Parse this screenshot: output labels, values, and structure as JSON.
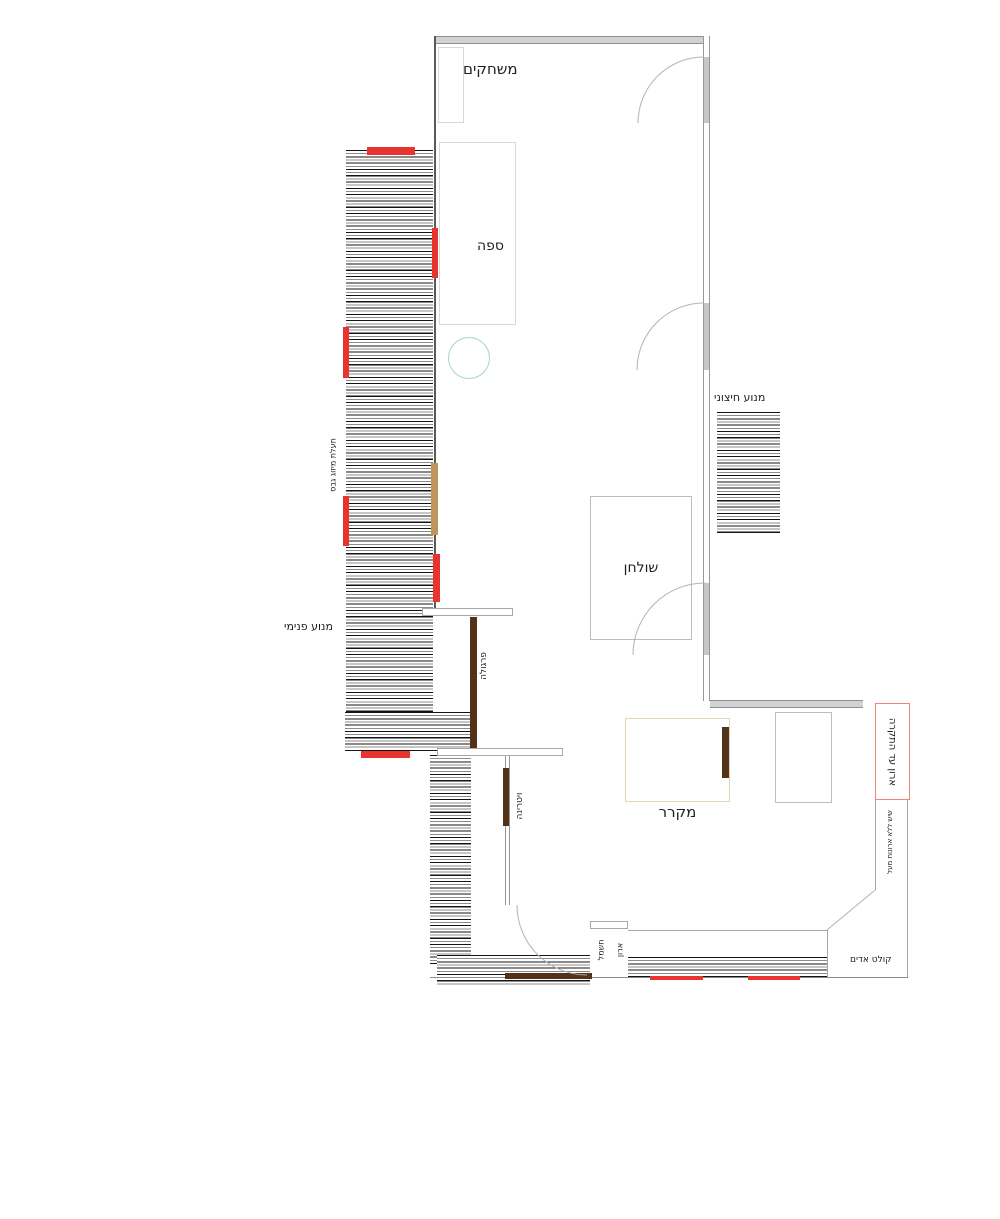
{
  "labels": {
    "games": "משחקים",
    "sofa": "ספה",
    "table": "שולחן",
    "fridge": "מקרר",
    "motor_external": "מנוע חיצוני",
    "motor_internal": "מנוע פנימי",
    "ac_duct": "תעלת מיזוג גבס",
    "pergola": "פרגולה",
    "vitrine": "ויטרינה",
    "closet_to_ceiling": "ארון עד התקרה",
    "counter_no_cabinets": "שיש ללא ארונות מעל",
    "vapor_hood": "קולט אדים",
    "electric_word1": "ארון",
    "electric_word2": "חשמל"
  },
  "colors": {
    "window_marker_red": "#e8332e",
    "door_bar_brown": "#52331a",
    "bar_tan": "#c0955c",
    "wall_gray": "#d2d2d2",
    "closet_outline_red": "#f08672",
    "circle_teal": "#a5d6c3"
  }
}
